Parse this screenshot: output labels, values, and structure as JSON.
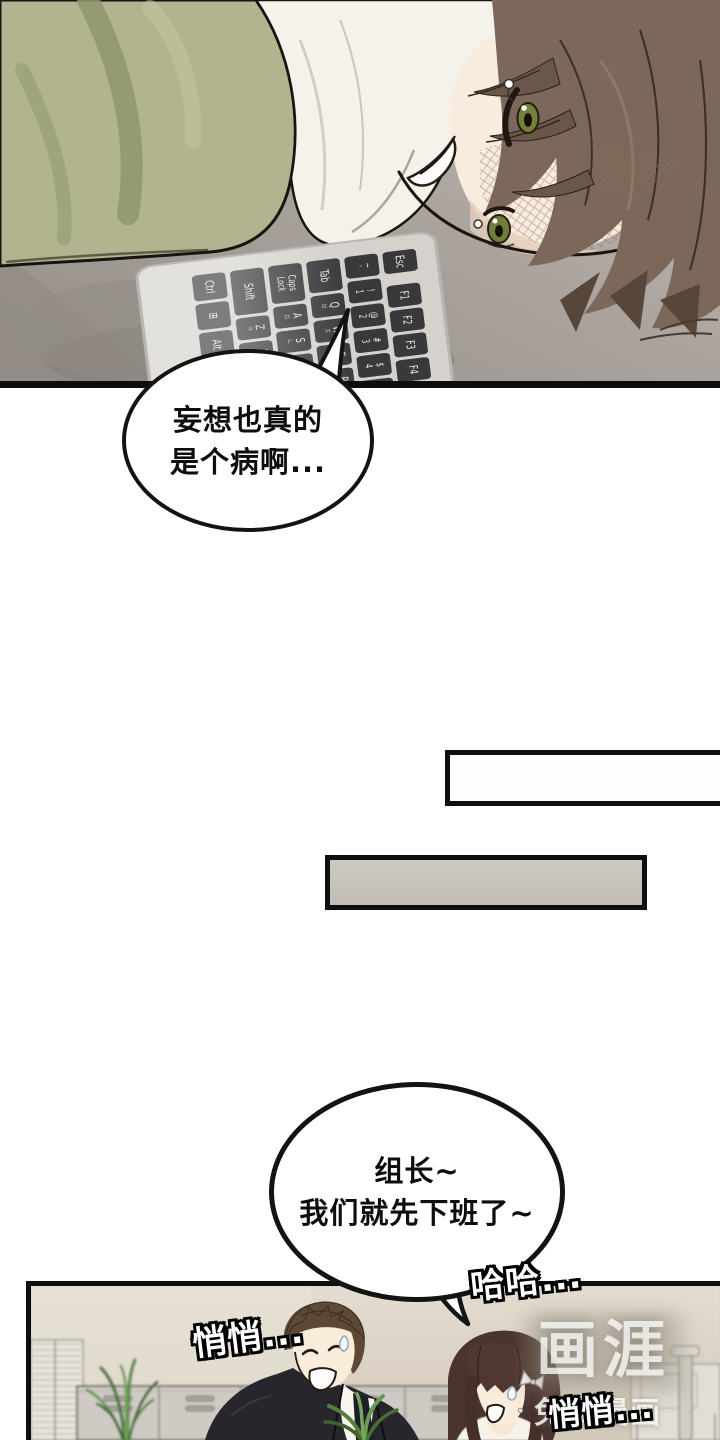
{
  "bubble1": {
    "lines": [
      "妄想也真的",
      "是个病啊..."
    ]
  },
  "bubble2": {
    "lines": [
      "组长~",
      "我们就先下班了~"
    ]
  },
  "sfx": {
    "haha": "哈哈...",
    "whisper_1": "悄悄...",
    "whisper_2": "悄悄..."
  },
  "watermark": {
    "logo": "画涯",
    "tagline": "免费漫画"
  },
  "keyboard": {
    "rows": [
      [
        {
          "l": "Esc"
        },
        {
          "l": "F1"
        },
        {
          "l": "F2"
        },
        {
          "l": "F3"
        },
        {
          "l": "F4"
        },
        {
          "l": "F5"
        }
      ],
      [
        {
          "l": "~\n`"
        },
        {
          "l": "!\n1"
        },
        {
          "l": "@\n2"
        },
        {
          "l": "#\n3"
        },
        {
          "l": "$\n4"
        },
        {
          "l": "%\n5"
        },
        {
          "l": "^\n6"
        }
      ],
      [
        {
          "l": "Tab"
        },
        {
          "l": "Q",
          "s": "ㅂ"
        },
        {
          "l": "W",
          "s": "ㅈ"
        },
        {
          "l": "E",
          "s": "ㄷ"
        },
        {
          "l": "R",
          "s": "ㄱ"
        },
        {
          "l": "T",
          "s": "ㅅ"
        }
      ],
      [
        {
          "l": "Caps\nLock"
        },
        {
          "l": "A",
          "s": "ㅁ"
        },
        {
          "l": "S",
          "s": "ㄴ"
        },
        {
          "l": "D",
          "s": "ㅇ"
        },
        {
          "l": "F",
          "s": "ㄹ"
        },
        {
          "l": "G",
          "s": "ㅎ"
        }
      ],
      [
        {
          "l": "Shift"
        },
        {
          "l": "Z",
          "s": "ㅋ"
        },
        {
          "l": "X",
          "s": "ㅌ"
        },
        {
          "l": "C",
          "s": "ㅊ"
        },
        {
          "l": "V",
          "s": "ㅍ"
        },
        {
          "l": "B",
          "s": "ㅠ"
        }
      ],
      [
        {
          "l": "Ctrl"
        },
        {
          "l": "⊞"
        },
        {
          "l": "Alt"
        },
        {
          "l": "한자"
        },
        {
          "l": ""
        }
      ]
    ]
  },
  "palette": {
    "panel_border": "#0f0f0f",
    "desk": "#aaa39d",
    "cushion_green": "#b2b48f",
    "shirt_white": "#f5f1eb",
    "skin": "#f8ecdf",
    "hair_brown": "#7b685a",
    "eye_green": "#75803d",
    "keyboard_body": "#d5d2cd",
    "key_dark": "#39383a",
    "caption_gray": "#c9c4bd",
    "office_wall": "#d9d1c4",
    "locker_gray": "#cfcbc4",
    "plant_green": "#5d8a49",
    "suit_black": "#26262c",
    "woman_hair": "#4b3430"
  }
}
